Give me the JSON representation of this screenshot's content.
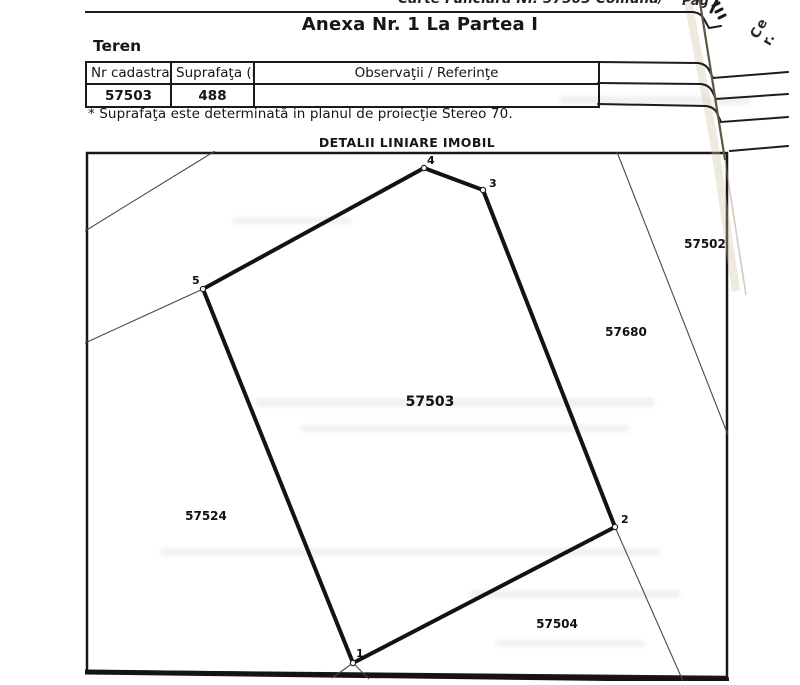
{
  "document": {
    "top_line": "Carte Funciară Nr. 57503 Comuna/",
    "page_corner": "Pag",
    "title": "Anexa Nr. 1 La Partea I",
    "section": "Teren",
    "footnote": "* Suprafaţa este determinată in planul de proiecţie Stereo 70.",
    "edge_text": [
      "Ce",
      "r."
    ]
  },
  "table": {
    "columns": [
      "Nr cadastral",
      "Suprafaţa (mp)*",
      "Observaţii / Referinţe"
    ],
    "rows": [
      {
        "nr_cadastral": "57503",
        "suprafata": "488",
        "observatii": ""
      }
    ]
  },
  "plan": {
    "title": "DETALII LINIARE IMOBIL",
    "main_parcel": {
      "label": "57503",
      "label_x": 345,
      "label_y": 255,
      "vertices": [
        {
          "n": "1",
          "x": 268,
          "y": 512,
          "lx": 271,
          "ly": 506
        },
        {
          "n": "2",
          "x": 530,
          "y": 376,
          "lx": 536,
          "ly": 372
        },
        {
          "n": "3",
          "x": 398,
          "y": 39,
          "lx": 404,
          "ly": 36
        },
        {
          "n": "4",
          "x": 339,
          "y": 17,
          "lx": 342,
          "ly": 13
        },
        {
          "n": "5",
          "x": 118,
          "y": 138,
          "lx": 107,
          "ly": 133
        }
      ]
    },
    "neighbors": [
      {
        "label": "57502",
        "x": 620,
        "y": 97
      },
      {
        "label": "57680",
        "x": 541,
        "y": 185
      },
      {
        "label": "57524",
        "x": 121,
        "y": 369
      },
      {
        "label": "57504",
        "x": 472,
        "y": 477
      }
    ],
    "boundaries": [
      {
        "x1": 130,
        "y1": 0,
        "x2": 0,
        "y2": 80
      },
      {
        "x1": 118,
        "y1": 138,
        "x2": 0,
        "y2": 192
      },
      {
        "x1": 532,
        "y1": 1,
        "x2": 643,
        "y2": 284
      },
      {
        "x1": 530,
        "y1": 376,
        "x2": 598,
        "y2": 530
      },
      {
        "x1": 268,
        "y1": 512,
        "x2": 247,
        "y2": 527
      },
      {
        "x1": 268,
        "y1": 512,
        "x2": 284,
        "y2": 528
      }
    ]
  },
  "colors": {
    "ink": "#1a1a1a",
    "paper": "#ffffff",
    "paper_edge": "#5f5546"
  }
}
